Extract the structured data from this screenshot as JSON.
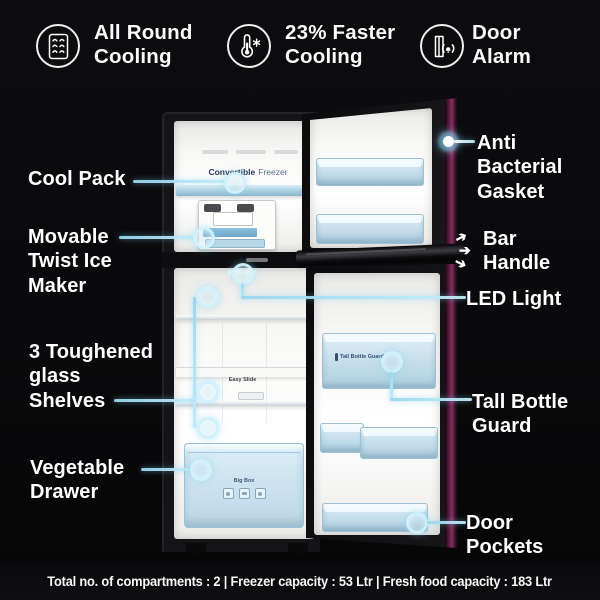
{
  "top_features": [
    {
      "label": "All Round\nCooling",
      "icon": "vent-grille-icon"
    },
    {
      "label": "23% Faster\nCooling",
      "icon": "thermometer-snowflake-icon"
    },
    {
      "label": "Door\nAlarm",
      "icon": "door-alarm-icon"
    }
  ],
  "left_callouts": {
    "cool_pack": "Cool Pack",
    "ice_maker": "Movable\nTwist Ice\nMaker",
    "shelves": "3 Toughened\nglass\nShelves",
    "vegetable_drawer": "Vegetable\nDrawer"
  },
  "right_callouts": {
    "gasket": "Anti\nBacterial\nGasket",
    "bar_handle": "Bar\nHandle",
    "led_light": "LED Light",
    "bottle_guard": "Tall Bottle\nGuard",
    "door_pockets": "Door\nPockets"
  },
  "fridge_labels": {
    "convertible_bold": "Convertible",
    "convertible_rest": "Freezer",
    "easy_slide": "Easy Slide",
    "big_box": "Big Box",
    "tall_bottle_guard_bin": "Tall Bottle Guard"
  },
  "footer": "Total no. of compartments : 2 | Freezer capacity : 53 Ltr | Fresh food capacity : 183 Ltr",
  "colors": {
    "callout_accent": "#a5e0f0",
    "gasket_purple": "#83305f",
    "bin_blue": "#cfe3ee",
    "text": "#ffffff",
    "background": "#0a0a0c"
  }
}
